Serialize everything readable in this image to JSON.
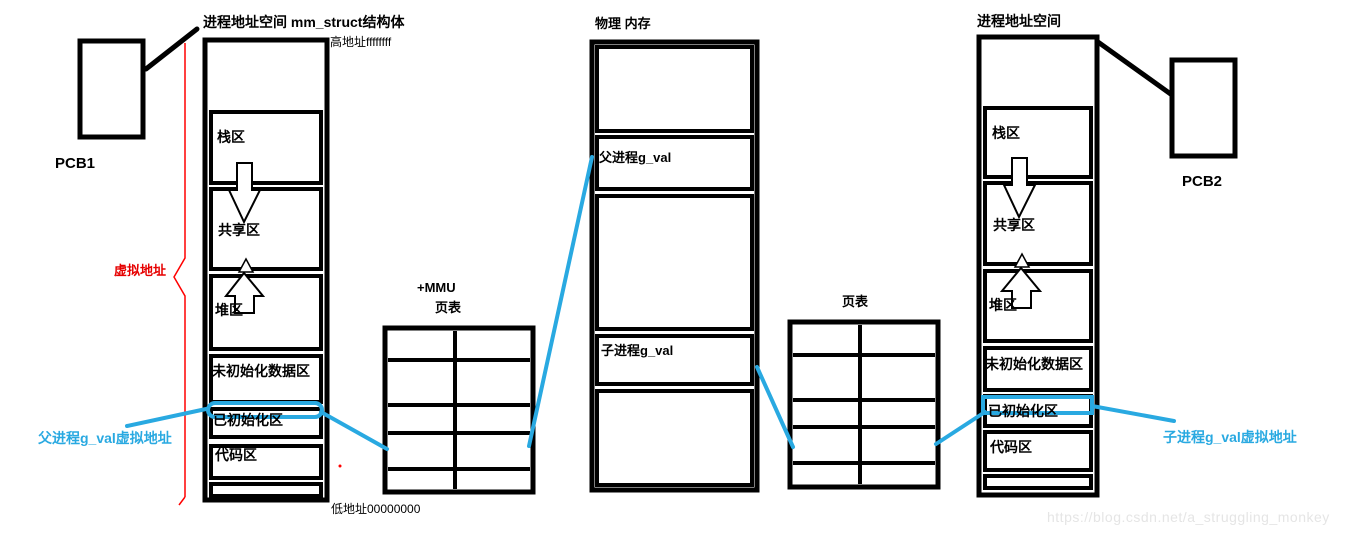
{
  "colors": {
    "line": "#000000",
    "highlight_cyan": "#29a9e1",
    "bracket_red": "#ff0000",
    "watermark_gray": "#e5e5e5"
  },
  "parent_space": {
    "title": "进程地址空间 mm_struct结构体",
    "high_address": "高地址ffffffff",
    "low_address": "低地址00000000",
    "pcb": "PCB1",
    "virtual_address_label": "虚拟地址",
    "sections": [
      "栈区",
      "共享区",
      "堆区",
      "未初始化数据区",
      "已初始化区",
      "代码区"
    ],
    "pointer_label": "父进程g_val虚拟地址"
  },
  "mmu": {
    "mmu_label": "+MMU",
    "page_table_title": "页表"
  },
  "physical_memory": {
    "title": "物理 内存",
    "parent_cell": "父进程g_val",
    "child_cell": "子进程g_val"
  },
  "child_page_table": {
    "page_table_title": "页表"
  },
  "child_space": {
    "title": "进程地址空间",
    "pcb": "PCB2",
    "sections": [
      "栈区",
      "共享区",
      "堆区",
      "未初始化数据区",
      "已初始化区",
      "代码区"
    ],
    "pointer_label": "子进程g_val虚拟地址"
  },
  "watermark": "https://blog.csdn.net/a_struggling_monkey"
}
